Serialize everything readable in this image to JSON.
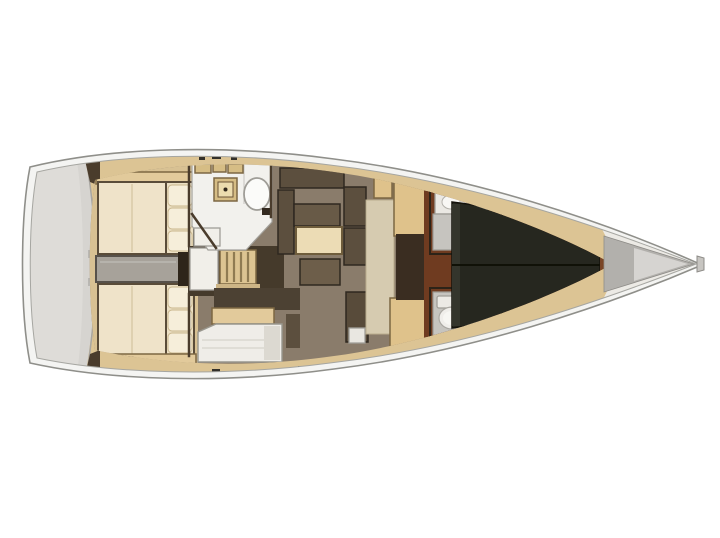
{
  "page": {
    "type": "sailing-yacht-floor-plan",
    "orientation": "bow-right"
  },
  "colors": {
    "background": "#ffffff",
    "hull_fill": "#f4f4f2",
    "deck_pale": "#eceae5",
    "deck_wood": "#dcc494",
    "aft_floor": "#d8c193",
    "transom": "#d6d4d0",
    "transom_inner": "#dedcd8",
    "transom_notch": "#b9b7b3",
    "wall": "#4a3c2c",
    "wall_dark": "#2e251a",
    "wood_trim": "#e2ca9b",
    "berth_cream": "#efe3c9",
    "pillow_panel": "#ece0c4",
    "pillow": "#f6eeda",
    "engine_gray": "#a7a29a",
    "white_box": "#f1efe9",
    "ladder": "#dcc492",
    "ladder_step": "#cdb586",
    "walkway_dark": "#453a2b",
    "galley_white": "#f2f1ed",
    "locker_tan": "#d6bd85",
    "stove_inner": "#ecdcae",
    "stove_dot": "#33291c",
    "sink_white": "#fbfbf9",
    "nav_back": "#4c4133",
    "nav_white": "#efede8",
    "nav_side": "#dcd9d1",
    "salon_floor": "#8a7c6b",
    "sofa": "#5c4f3e",
    "sofa_seat": "#685a47",
    "seat_dark": "#584b3a",
    "table": "#ecdcb5",
    "ottoman": "#6d5e4a",
    "foot_white": "#e9e7e1",
    "passage": "#d6cbb0",
    "cabinet": "#dfc28b",
    "corridor": "#3a2d21",
    "mahogany": "#6f3b20",
    "wood_sliver": "#7a4526",
    "berth_fore": "#26271f",
    "berth_foot": "#34352c",
    "head_white": "#eae8e3",
    "head_hatch": "#e9e7e2",
    "sink_top": "#f8f7f4",
    "dark_unit": "#33291f",
    "shower": "#c6c4bf",
    "toilet_tank": "#eceae5",
    "toilet": "#f0eeea",
    "toilet_seat": "#f7f6f2",
    "bow_locker": "#b2b0ac",
    "bow_locker_hi": "#d6d4d1",
    "bow_fitting": "#c7c5c1",
    "cleat": "#33302a"
  },
  "regions": {
    "transom": "stern-swim-platform",
    "aft_port": "aft-cabin-port-berth",
    "aft_stbd": "aft-cabin-starboard-berth",
    "engine": "engine-compartment",
    "ladder": "companionway-ladder",
    "galley": "galley",
    "nav": "chart-table",
    "salon": "salon",
    "heads": "forward-heads",
    "vberth": "forward-owner-berth",
    "bow": "anchor-locker"
  }
}
